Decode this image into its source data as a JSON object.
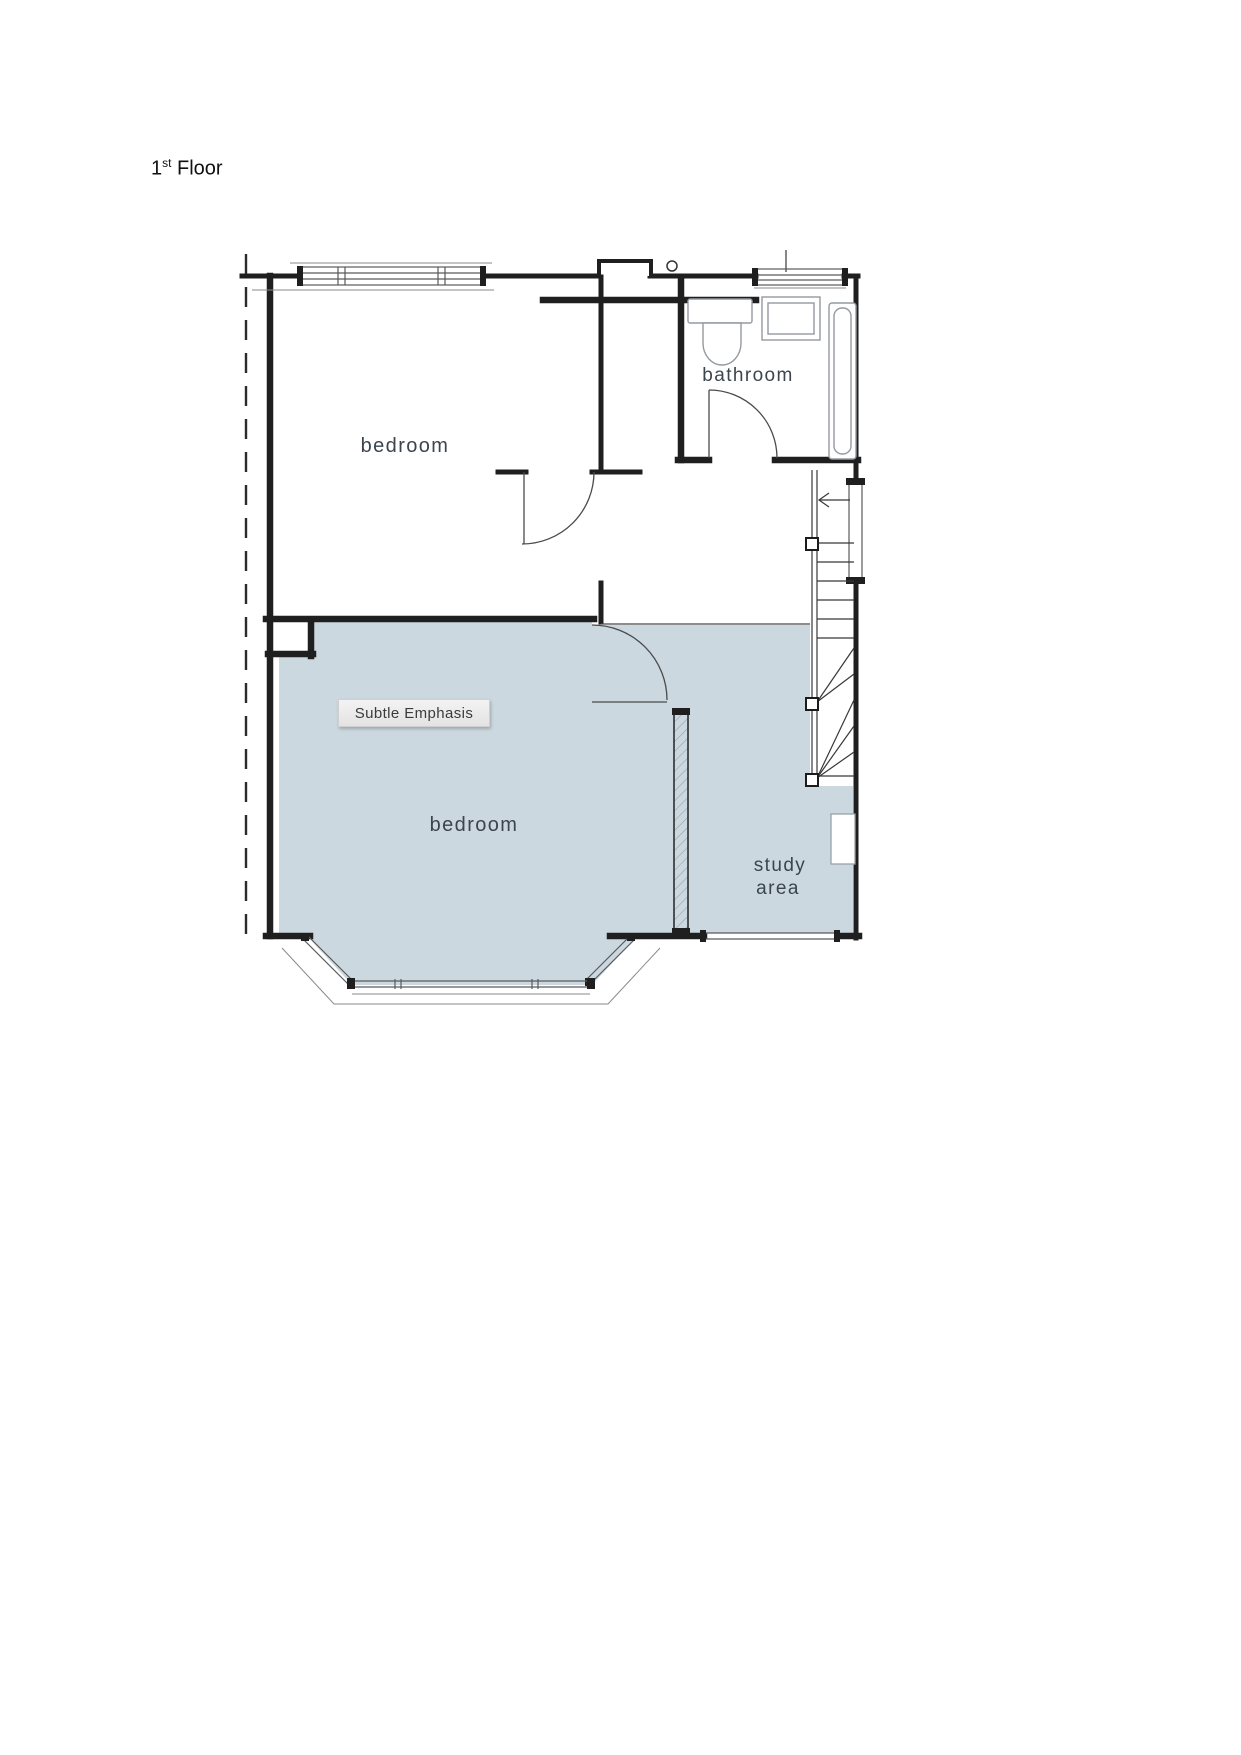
{
  "document": {
    "title_number": "1",
    "title_ordinal": "st",
    "title_rest": " Floor"
  },
  "floor_plan": {
    "labels": {
      "bedroom_top": "bedroom",
      "bathroom": "bathroom",
      "bedroom_bottom": "bedroom",
      "study_line1": "study",
      "study_line2": "area"
    },
    "annotation": {
      "text": "Subtle Emphasis"
    },
    "colors": {
      "wall": "#1f1f1f",
      "highlight_fill": "#ccd8e0",
      "label_text": "#3c454e",
      "annotation_bg": "#ececec",
      "annotation_text": "#3b3b3b"
    }
  }
}
